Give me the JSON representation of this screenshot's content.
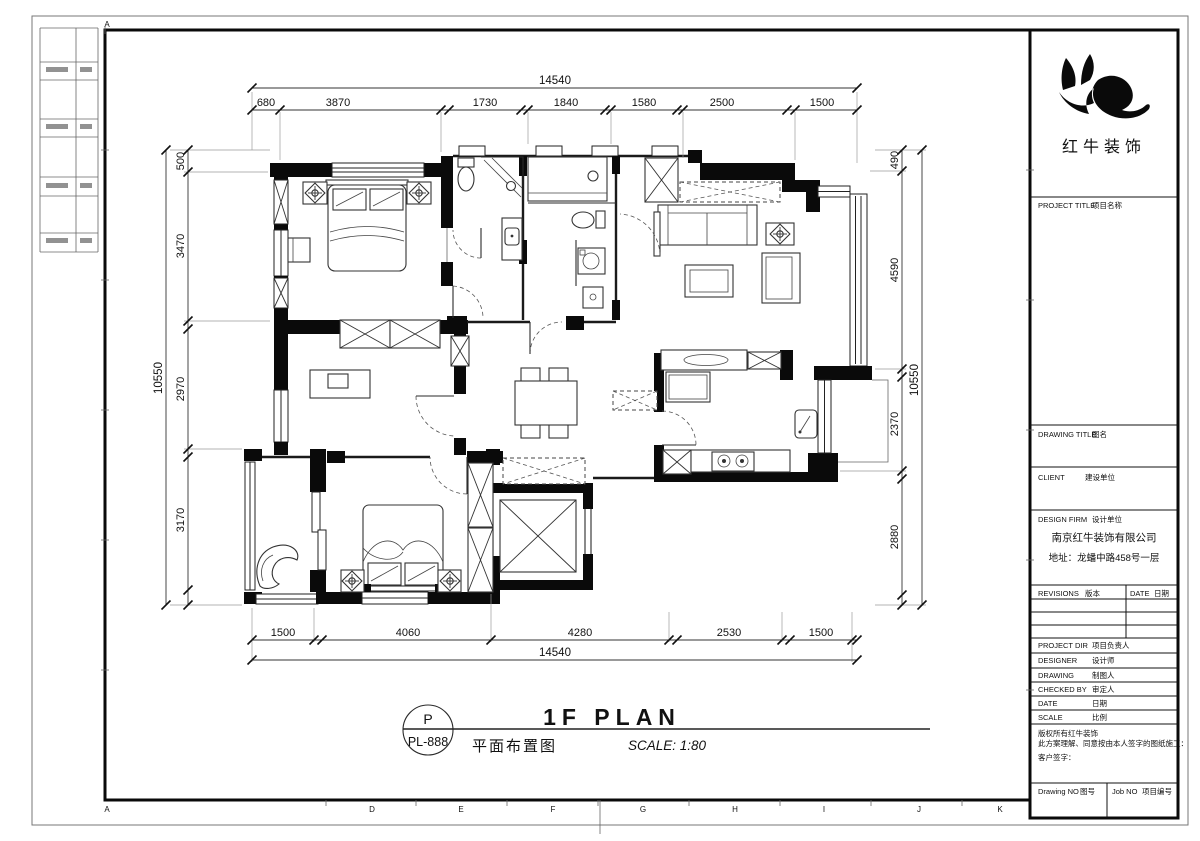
{
  "sheet": {
    "grid_letter_top": "A",
    "grid_letters_bottom": [
      "A",
      "D",
      "E",
      "F",
      "G",
      "H",
      "I",
      "J",
      "K"
    ]
  },
  "logo": {
    "company_name": "红牛装饰"
  },
  "title_block": {
    "project_title_en": "PROJECT TITLE",
    "project_title_cn": "项目名称",
    "drawing_title_en": "DRAWING TITLE",
    "drawing_title_cn": "图名",
    "client_en": "CLIENT",
    "client_cn": "建设单位",
    "design_firm_en": "DESIGN FIRM",
    "design_firm_cn": "设计单位",
    "firm_name": "南京红牛装饰有限公司",
    "firm_address": "地址：龙蟠中路458号一层",
    "revisions_en": "REVISIONS",
    "revisions_cn": "版本",
    "rev_date_en": "DATE",
    "rev_date_cn": "日期",
    "project_dir_en": "PROJECT DIR",
    "project_dir_cn": "项目负责人",
    "designer_en": "DESIGNER",
    "designer_cn": "设计师",
    "drawing_en": "DRAWING",
    "drawing_cn": "制图人",
    "checked_by_en": "CHECKED BY",
    "checked_by_cn": "审定人",
    "date_en": "DATE",
    "date_cn": "日期",
    "scale_en": "SCALE",
    "scale_cn": "比例",
    "copyright_line": "版权所有红牛装饰",
    "agreement_line": "此方案理解、同意按由本人签字的图纸施工：",
    "signature_line": "客户签字：",
    "drawing_no_en": "Drawing NO",
    "drawing_no_cn": "图号",
    "job_no_en": "Job NO",
    "job_no_cn": "项目编号"
  },
  "plan_title": {
    "stamp_top": "P",
    "stamp_code": "PL-888",
    "title_en": "1F PLAN",
    "title_cn": "平面布置图",
    "scale_note": "SCALE: 1:80"
  },
  "dimensions": {
    "top": {
      "total": "14540",
      "segments": [
        "680",
        "3870",
        "1730",
        "1840",
        "1580",
        "2500",
        "1500"
      ]
    },
    "bottom": {
      "total": "14540",
      "segments": [
        "1500",
        "4060",
        "4280",
        "2530",
        "1500"
      ]
    },
    "left": {
      "total": "10550",
      "segments": [
        "500",
        "3470",
        "2970",
        "3170"
      ]
    },
    "right": {
      "total": "10550",
      "segments": [
        "490",
        "4590",
        "2370",
        "2880"
      ]
    }
  }
}
